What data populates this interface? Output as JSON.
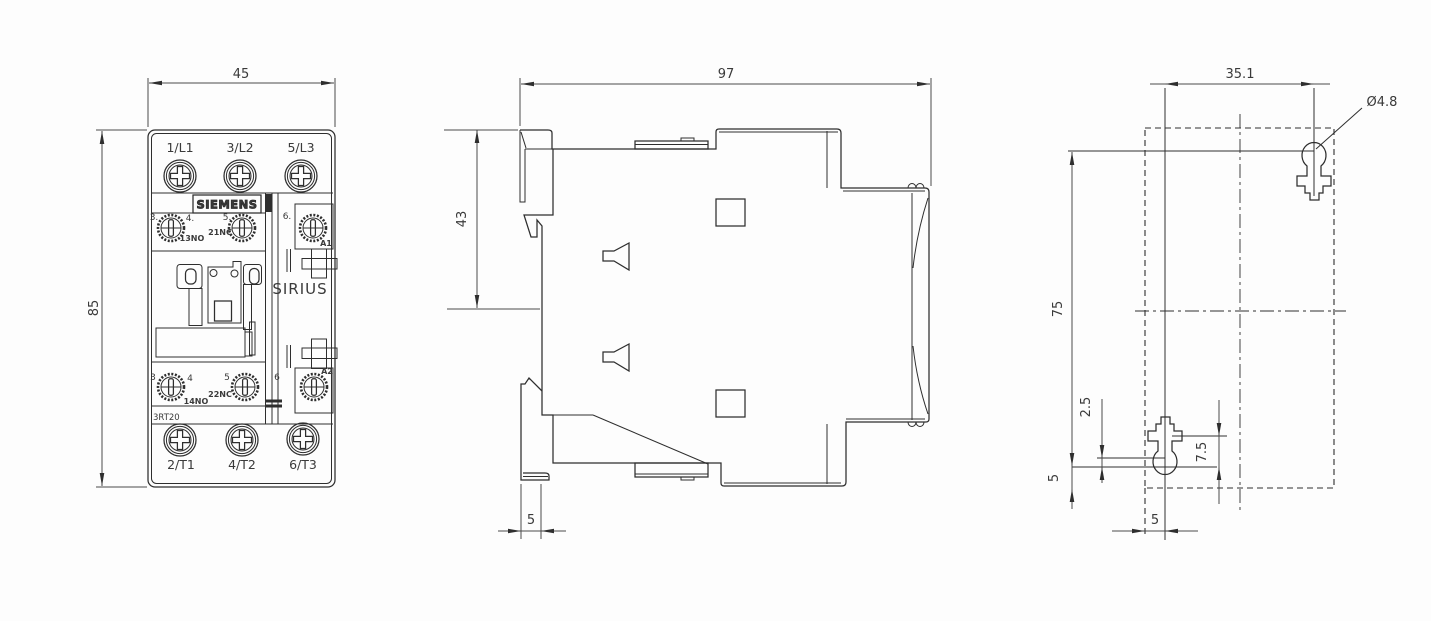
{
  "drawing": {
    "front_view": {
      "dim_width": "45",
      "dim_height": "85",
      "brand": "SIEMENS",
      "series": "SIRIUS",
      "model": "3RT20",
      "line_terminals": [
        "1/L1",
        "3/L2",
        "5/L3"
      ],
      "load_terminals": [
        "2/T1",
        "4/T2",
        "6/T3"
      ],
      "aux_top": {
        "n3": "3.",
        "n4": "4.",
        "n5": "5.",
        "n6": "6.",
        "no": "13NO",
        "nc": "21NC",
        "coil": "A1"
      },
      "aux_bottom": {
        "n3": "3",
        "n4": "4",
        "n5": "5",
        "n6": "6",
        "no": "14NO",
        "nc": "22NC",
        "coil": "A2"
      }
    },
    "side_view": {
      "dim_depth": "97",
      "dim_rail": "43",
      "dim_foot": "5"
    },
    "mounting_view": {
      "dim_spacing_h": "35.1",
      "hole_dia": "Ø4.8",
      "dim_spacing_v": "75",
      "dim_2_5": "2.5",
      "dim_5_left": "5",
      "dim_7_5": "7.5",
      "dim_5_bottom": "5"
    }
  }
}
